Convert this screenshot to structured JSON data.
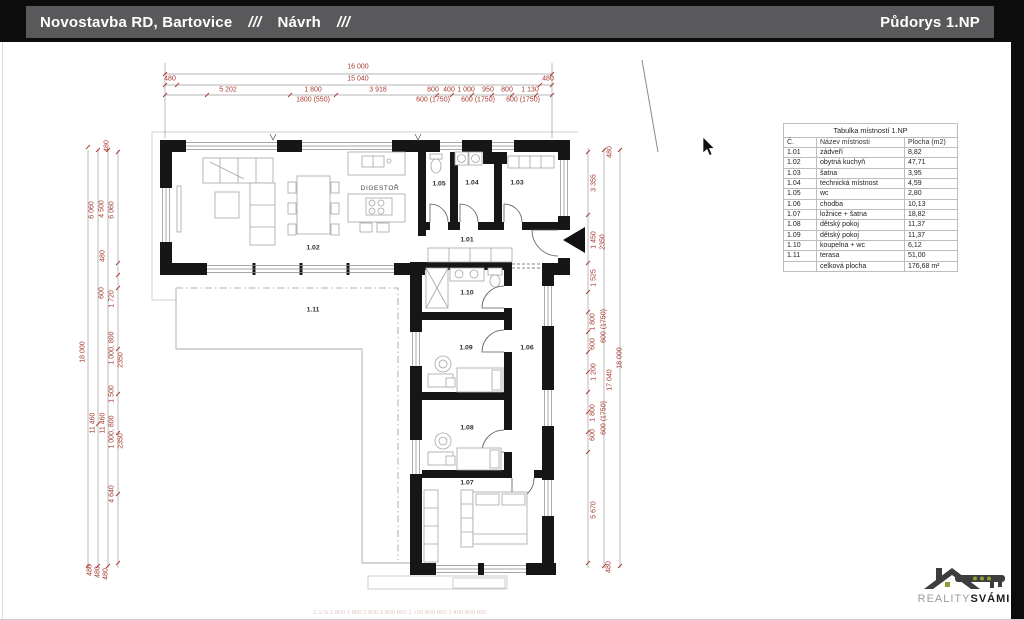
{
  "colors": {
    "dim_red": "#a8392e",
    "header_bg": "#59595b",
    "wall": "#161616",
    "logo_green": "#8fa033"
  },
  "header": {
    "title_left": "Novostavba RD, Bartovice",
    "sep1": "///",
    "subtitle": "Návrh",
    "sep2": "///",
    "title_right": "Půdorys 1.NP"
  },
  "room_table": {
    "title": "Tabulka místností 1.NP",
    "columns": [
      "Č.",
      "Název místnosti",
      "Plocha (m2)"
    ],
    "rows": [
      [
        "1.01",
        "zádveří",
        "8,82"
      ],
      [
        "1.02",
        "obytná kuchyň",
        "47,71"
      ],
      [
        "1.03",
        "šatna",
        "3,95"
      ],
      [
        "1.04",
        "technická místnost",
        "4,59"
      ],
      [
        "1.05",
        "wc",
        "2,80"
      ],
      [
        "1.06",
        "chodba",
        "10,13"
      ],
      [
        "1.07",
        "ložnice + šatna",
        "18,82"
      ],
      [
        "1.08",
        "dětský pokoj",
        "11,37"
      ],
      [
        "1.09",
        "dětský pokoj",
        "11,37"
      ],
      [
        "1.10",
        "koupelna + wc",
        "6,12"
      ],
      [
        "1.11",
        "terasa",
        "51,00"
      ]
    ],
    "total": [
      "",
      "celková plocha",
      "176,68 m²"
    ]
  },
  "rooms": [
    {
      "id": "1.01",
      "x": 467,
      "y": 241
    },
    {
      "id": "1.02",
      "x": 313,
      "y": 249
    },
    {
      "id": "1.03",
      "x": 517,
      "y": 184
    },
    {
      "id": "1.04",
      "x": 472,
      "y": 184
    },
    {
      "id": "1.05",
      "x": 439,
      "y": 185
    },
    {
      "id": "1.06",
      "x": 527,
      "y": 349
    },
    {
      "id": "1.07",
      "x": 467,
      "y": 484
    },
    {
      "id": "1.08",
      "x": 467,
      "y": 429
    },
    {
      "id": "1.09",
      "x": 466,
      "y": 349
    },
    {
      "id": "1.10",
      "x": 467,
      "y": 294
    },
    {
      "id": "1.11",
      "x": 313,
      "y": 311
    }
  ],
  "notes": [
    {
      "t": "DIGESTOŘ",
      "x": 380,
      "y": 189
    }
  ],
  "dimensions": {
    "horizontal": [
      {
        "t": "16 000",
        "x": 358,
        "y": 67
      },
      {
        "t": "480",
        "x": 170,
        "y": 79
      },
      {
        "t": "15 040",
        "x": 358,
        "y": 79
      },
      {
        "t": "480",
        "x": 548,
        "y": 79
      },
      {
        "t": "5 202",
        "x": 228,
        "y": 90
      },
      {
        "t": "1 800",
        "x": 313,
        "y": 90
      },
      {
        "t": "3 918",
        "x": 378,
        "y": 90
      },
      {
        "t": "800",
        "x": 433,
        "y": 90
      },
      {
        "t": "400",
        "x": 449,
        "y": 90
      },
      {
        "t": "1 000",
        "x": 466,
        "y": 90
      },
      {
        "t": "950",
        "x": 488,
        "y": 90
      },
      {
        "t": "800",
        "x": 507,
        "y": 90
      },
      {
        "t": "1 130",
        "x": 530,
        "y": 90
      },
      {
        "t": "1800 (550)",
        "x": 313,
        "y": 100
      },
      {
        "t": "600 (1750)",
        "x": 433,
        "y": 100
      },
      {
        "t": "600 (1750)",
        "x": 478,
        "y": 100
      },
      {
        "t": "600 (1750)",
        "x": 523,
        "y": 100
      },
      {
        "t": "1 175      1 800      1 800      1 800      1 800      600      1 750     600  600    1 400    600  600",
        "x": 400,
        "y": 613,
        "s": 6,
        "o": 0.3
      }
    ],
    "vertical": [
      {
        "t": "480",
        "x": 107,
        "y": 146
      },
      {
        "t": "6 060",
        "x": 92,
        "y": 210
      },
      {
        "t": "4 500",
        "x": 102,
        "y": 209
      },
      {
        "t": "6 060",
        "x": 112,
        "y": 210
      },
      {
        "t": "480",
        "x": 103,
        "y": 256
      },
      {
        "t": "600",
        "x": 102,
        "y": 293
      },
      {
        "t": "1 720",
        "x": 112,
        "y": 299
      },
      {
        "t": "18 000",
        "x": 83,
        "y": 352
      },
      {
        "t": "1 000, 800",
        "x": 112,
        "y": 348
      },
      {
        "t": "2350",
        "x": 121,
        "y": 360
      },
      {
        "t": "1 500",
        "x": 112,
        "y": 394
      },
      {
        "t": "11 460",
        "x": 93,
        "y": 423
      },
      {
        "t": "11 460",
        "x": 103,
        "y": 423
      },
      {
        "t": "1 000, 800",
        "x": 112,
        "y": 432
      },
      {
        "t": "2350",
        "x": 121,
        "y": 441
      },
      {
        "t": "4 640",
        "x": 112,
        "y": 494
      },
      {
        "t": "480",
        "x": 90,
        "y": 570
      },
      {
        "t": "480",
        "x": 98,
        "y": 572
      },
      {
        "t": "480",
        "x": 106,
        "y": 574
      },
      {
        "t": "480",
        "x": 610,
        "y": 152
      },
      {
        "t": "3 355",
        "x": 594,
        "y": 183
      },
      {
        "t": "1 450",
        "x": 594,
        "y": 240
      },
      {
        "t": "2350",
        "x": 603,
        "y": 242
      },
      {
        "t": "1 525",
        "x": 594,
        "y": 278
      },
      {
        "t": "1 800",
        "x": 593,
        "y": 322
      },
      {
        "t": "600 (1750)",
        "x": 604,
        "y": 326
      },
      {
        "t": "600",
        "x": 593,
        "y": 344
      },
      {
        "t": "1 200",
        "x": 594,
        "y": 372
      },
      {
        "t": "17 040",
        "x": 610,
        "y": 380
      },
      {
        "t": "18 000",
        "x": 620,
        "y": 358
      },
      {
        "t": "1 800",
        "x": 593,
        "y": 413
      },
      {
        "t": "600 (1750)",
        "x": 604,
        "y": 418
      },
      {
        "t": "600",
        "x": 593,
        "y": 435
      },
      {
        "t": "5 670",
        "x": 594,
        "y": 510
      },
      {
        "t": "480",
        "x": 609,
        "y": 567
      }
    ]
  },
  "logo": {
    "gray": "REALITY",
    "bold": "SVÁMI"
  }
}
